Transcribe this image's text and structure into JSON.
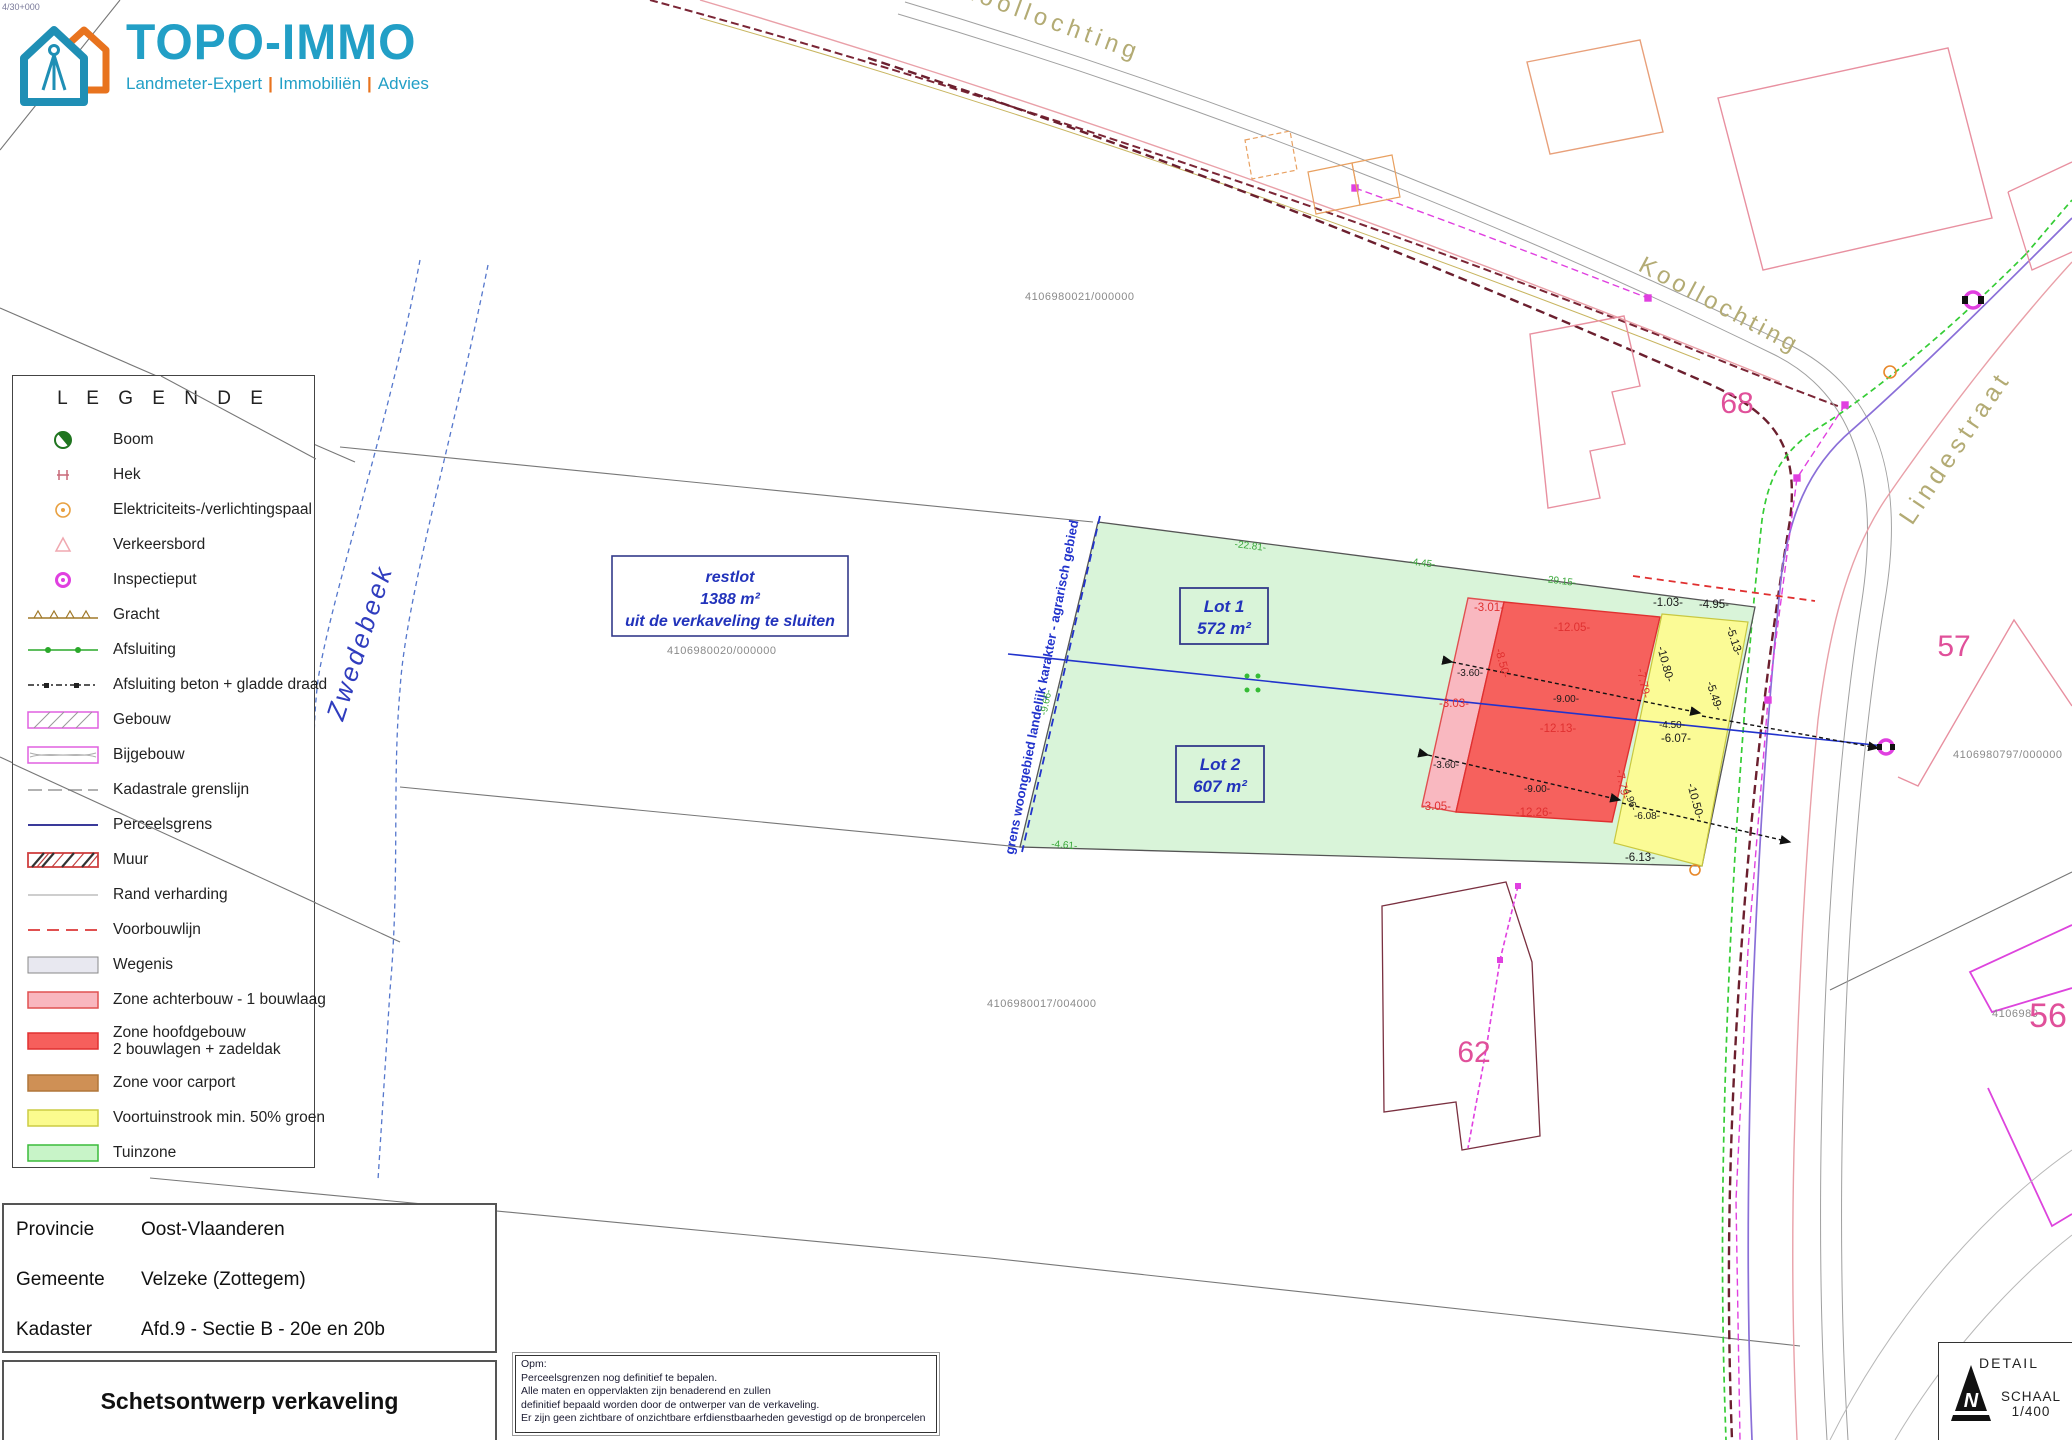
{
  "corner_ref": "4/30+000",
  "logo": {
    "title": "TOPO-IMMO",
    "tagline": [
      "Landmeter-Expert",
      "Immobiliën",
      "Advies"
    ],
    "sep": "|",
    "colors": {
      "blue": "#229fc6",
      "orange": "#e8731e"
    }
  },
  "legend": {
    "title": "L E G E N D E",
    "items": [
      {
        "label": "Boom"
      },
      {
        "label": "Hek"
      },
      {
        "label": "Elektriciteits-/verlichtingspaal"
      },
      {
        "label": "Verkeersbord"
      },
      {
        "label": "Inspectieput"
      },
      {
        "label": "Gracht"
      },
      {
        "label": "Afsluiting"
      },
      {
        "label": "Afsluiting beton + gladde draad"
      },
      {
        "label": "Gebouw"
      },
      {
        "label": "Bijgebouw"
      },
      {
        "label": "Kadastrale grenslijn"
      },
      {
        "label": "Perceelsgrens"
      },
      {
        "label": "Muur"
      },
      {
        "label": "Rand verharding"
      },
      {
        "label": "Voorbouwlijn"
      },
      {
        "label": "Wegenis"
      },
      {
        "label": "Zone achterbouw - 1 bouwlaag"
      },
      {
        "label": "Zone hoofdgebouw",
        "label2": "2 bouwlagen + zadeldak"
      },
      {
        "label": "Zone voor carport"
      },
      {
        "label": "Voortuinstrook min. 50% groen"
      },
      {
        "label": "Tuinzone"
      }
    ]
  },
  "info": {
    "rows": [
      {
        "k": "Provincie",
        "v": "Oost-Vlaanderen"
      },
      {
        "k": "Gemeente",
        "v": "Velzeke (Zottegem)"
      },
      {
        "k": "Kadaster",
        "v": "Afd.9 - Sectie B - 20e en 20b"
      }
    ],
    "title": "Schetsontwerp verkaveling"
  },
  "note": {
    "lines": [
      "Opm:",
      "Perceelsgrenzen nog definitief te bepalen.",
      "Alle maten en oppervlakten zijn benaderend en zullen",
      "definitief bepaald worden door de ontwerper van de verkaveling.",
      "Er zijn geen zichtbare of onzichtbare erfdienstbaarheden gevestigd op de bronpercelen"
    ]
  },
  "detail": {
    "label": "DETAIL",
    "scale_label": "SCHAAL",
    "scale_value": "1/400"
  },
  "map": {
    "streets": {
      "koollochting": "Koollochting",
      "lindestraat": "Lindestraat",
      "beek": "Zwedebeek"
    },
    "zone_boundary": "grens woongebied landelijk karakter - agrarisch gebied",
    "restlot": {
      "l1": "restlot",
      "l2": "1388 m²",
      "l3": "uit de verkaveling te sluiten"
    },
    "lots": [
      {
        "name": "Lot 1",
        "area": "572 m²"
      },
      {
        "name": "Lot 2",
        "area": "607 m²"
      }
    ],
    "parcels": [
      "4106980021/000000",
      "4106980020/000000",
      "4106980017/004000",
      "4106980797/000000",
      "4106980"
    ],
    "houses": [
      "68",
      "57",
      "62",
      "56"
    ],
    "dims_black": [
      "-1.03-",
      "-4.95-",
      "-5.13-",
      "-10.80-",
      "-5.49-",
      "-6.07-",
      "-10.50-",
      "-6.13-",
      "-3.60-",
      "-9.00-",
      "-4.50-",
      "-3.60-",
      "-9.00-",
      "-4.96-",
      "-6.08-"
    ],
    "dims_red": [
      "-3.01-",
      "-12.05-",
      "-8.50-",
      "-3.03-",
      "-12.13-",
      "-7.79-",
      "-3.05-",
      "-12.26-",
      "-7.79-"
    ],
    "dims_green": [
      "-22.81-",
      "-4.45-",
      "-29.15-",
      "-4.61-",
      "-9.66-"
    ],
    "zone_colors": {
      "tuinzone": "#d9f4d9",
      "hoofdgebouw": "#f6615d",
      "achterbouw": "#f9b8c0",
      "voortuin": "#fbfb96",
      "carport": "#cf9055"
    }
  }
}
